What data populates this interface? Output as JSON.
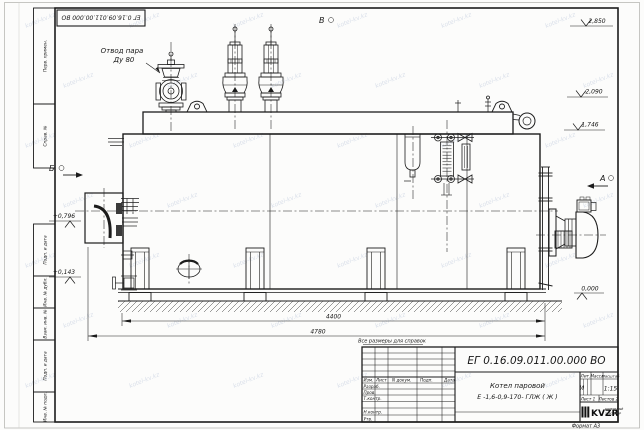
{
  "document": {
    "number": "ЕГ 0.16.09.011.00.000  ВО",
    "corner_number": "ЕГ 0.16.09.011.00.000  ВО",
    "format_note": "Формат А3",
    "reference_note": "Все размеры для справок"
  },
  "annotations": {
    "steam_outlet_line1": "Отвод пара",
    "steam_outlet_line2": "Ду 80",
    "view_a": "А",
    "view_b": "Б",
    "view_v": "В"
  },
  "elevation_marks": {
    "top": "2,850",
    "drum": "2,090",
    "body_top": "1,746",
    "ground": "0,000",
    "left_upper": "+0,796",
    "left_lower": "+0,143"
  },
  "dimensions": {
    "inner_width": "4400",
    "overall_width": "4780"
  },
  "title_block": {
    "doc_number": "ЕГ 0.16.09.011.00.000  ВО",
    "product_name": "Котел паровой",
    "product_type": "Е -1,6-0,9-170- ГЛЖ ( Ж )",
    "columns": {
      "izm": "Изм.",
      "list": "Лист",
      "ndoc": "N докум.",
      "podp": "Подп.",
      "data": "Дата"
    },
    "rows": {
      "razrab": "Разраб.",
      "prov": "Пров.",
      "tkontr": "Т.контр.",
      "nkontr": "Н.контр.",
      "utv": "Утв."
    },
    "lit_header": "Лит.",
    "mass_header": "Масса",
    "scale_header": "Масштаб",
    "lit_value": "И",
    "scale_value": "1:15",
    "sheet_label": "Лист 1",
    "sheets_label": "Листов  2",
    "logo_text": "KVZR",
    "company_line1": "КОТЕЛЬНЫЙ",
    "company_line2": "ЗАВОД РЗР"
  },
  "margin_stamps": [
    "Перв. примен.",
    "Справ. №",
    "Подп. и дата",
    "Инв. № дубл.",
    "Взам. инв. №",
    "Подп. и дата",
    "Инв. № подл."
  ],
  "watermark": {
    "text": "kotel-kv.kz"
  },
  "colors": {
    "line": "#1c1c1c",
    "watermark": "#b7c3d8",
    "paper": "#fcfcfb"
  }
}
